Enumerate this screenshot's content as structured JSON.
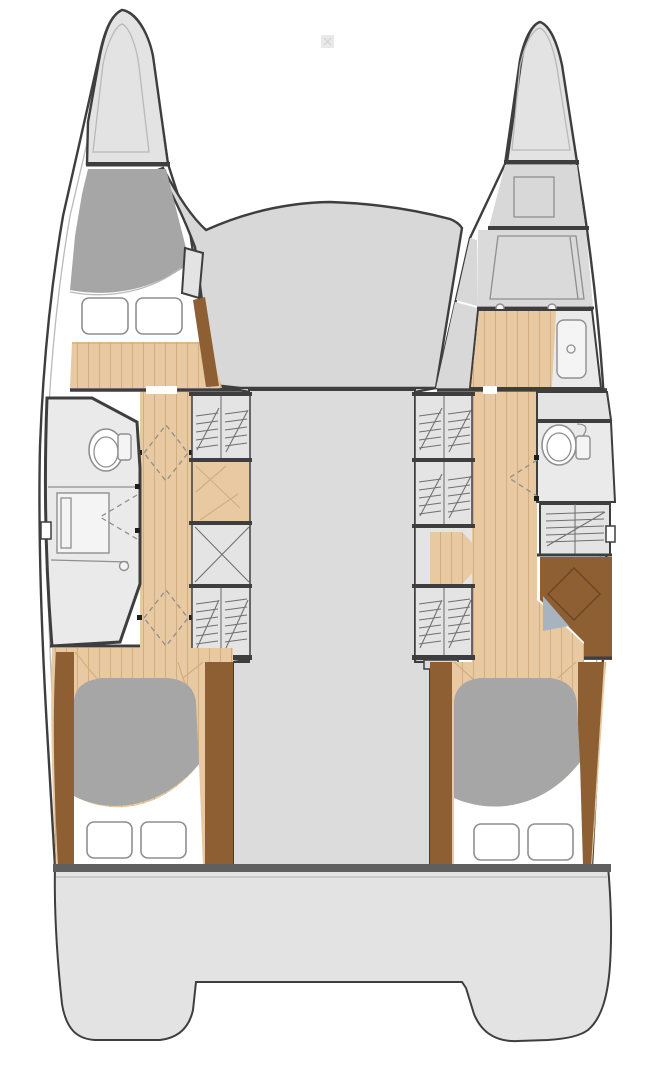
{
  "figure": {
    "kind": "catamaran-yacht-floor-plan",
    "views": [
      "deck-plan-top-view"
    ]
  },
  "colors": {
    "white": "#ffffff",
    "outline": "#3e3e3e",
    "line": "#8f8f8f",
    "lineLight": "#b9b9b9",
    "tip": "#e3e3e3",
    "tipInner": "#dadada",
    "deck": "#d8d8d8",
    "salon": "#dcdcdc",
    "room": "#eaeaea",
    "locker": "#e4e4e4",
    "hatch": "#6f6f6f",
    "wood": "#e8c9a1",
    "woodLine": "#d2ae7f",
    "woodDark": "#8d5f33",
    "duvet": "#a6a6a6",
    "platform": "#e3e3e3",
    "band": "#5f5f5f",
    "tread": "#a7b4c0",
    "stairLine": "#6b4526",
    "fixture": "#f4f4f4",
    "wm": "#e9e9e9"
  },
  "rooms": {
    "port_hull": [
      "bow-locker",
      "forward-cabin",
      "bathroom",
      "corridor",
      "wardrobes",
      "aft-cabin"
    ],
    "starboard_hull": [
      "bow-locker",
      "forepeak-berth",
      "shower-room",
      "toilet-room",
      "wardrobes",
      "corridor",
      "companionway-stairs",
      "aft-cabin"
    ],
    "center": [
      "foredeck",
      "salon",
      "stern-platform"
    ]
  },
  "fixtures": [
    "toilet",
    "vanity-counter",
    "shower-drain",
    "double-bed",
    "pillows",
    "deck-hatch",
    "door-swing"
  ]
}
